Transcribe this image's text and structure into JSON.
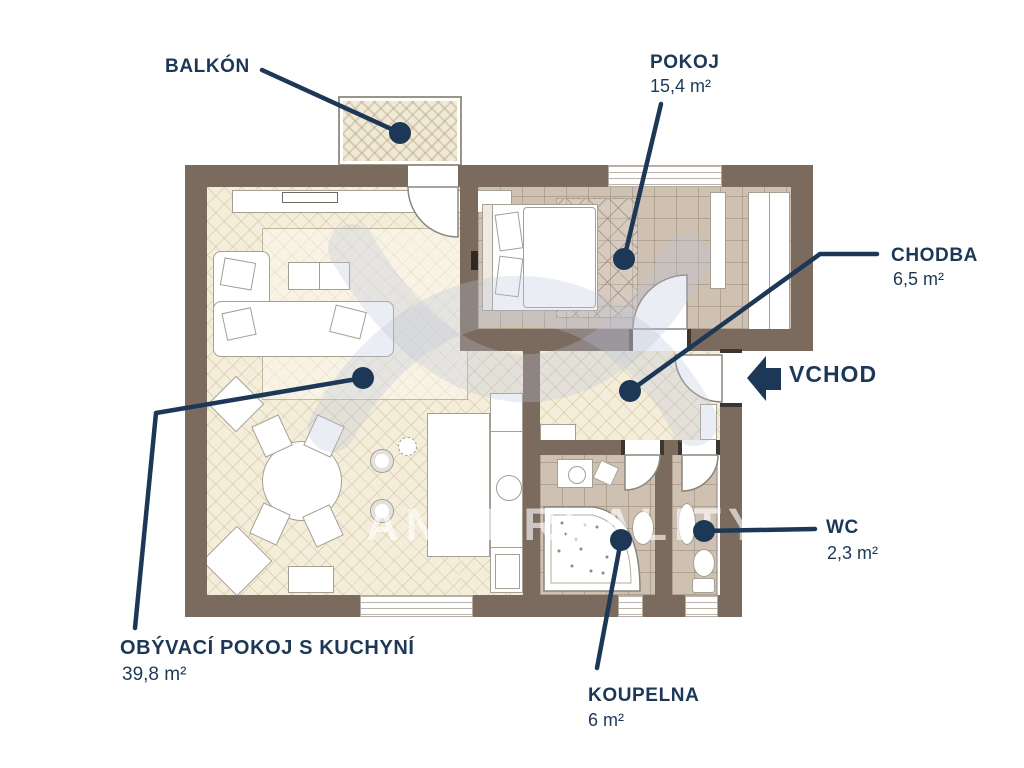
{
  "watermark": {
    "text": "ANDI REALITY"
  },
  "colors": {
    "accent_navy": "#1d3857",
    "wall_brown": "#7b6b5f",
    "floor_light": "#f4edda",
    "floor_dark": "#cfc1b2",
    "background": "#ffffff"
  },
  "labels": {
    "balkon": {
      "title": "BALKÓN",
      "area": ""
    },
    "pokoj": {
      "title": "POKOJ",
      "area": "15,4 m²"
    },
    "chodba": {
      "title": "CHODBA",
      "area": "6,5 m²"
    },
    "vchod": {
      "title": "VCHOD",
      "area": ""
    },
    "wc": {
      "title": "WC",
      "area": "2,3 m²"
    },
    "koupelna": {
      "title": "KOUPELNA",
      "area": "6 m²"
    },
    "obyvaci_pokoj": {
      "title": "OBÝVACÍ POKOJ S KUCHYNÍ",
      "area": "39,8 m²"
    }
  }
}
